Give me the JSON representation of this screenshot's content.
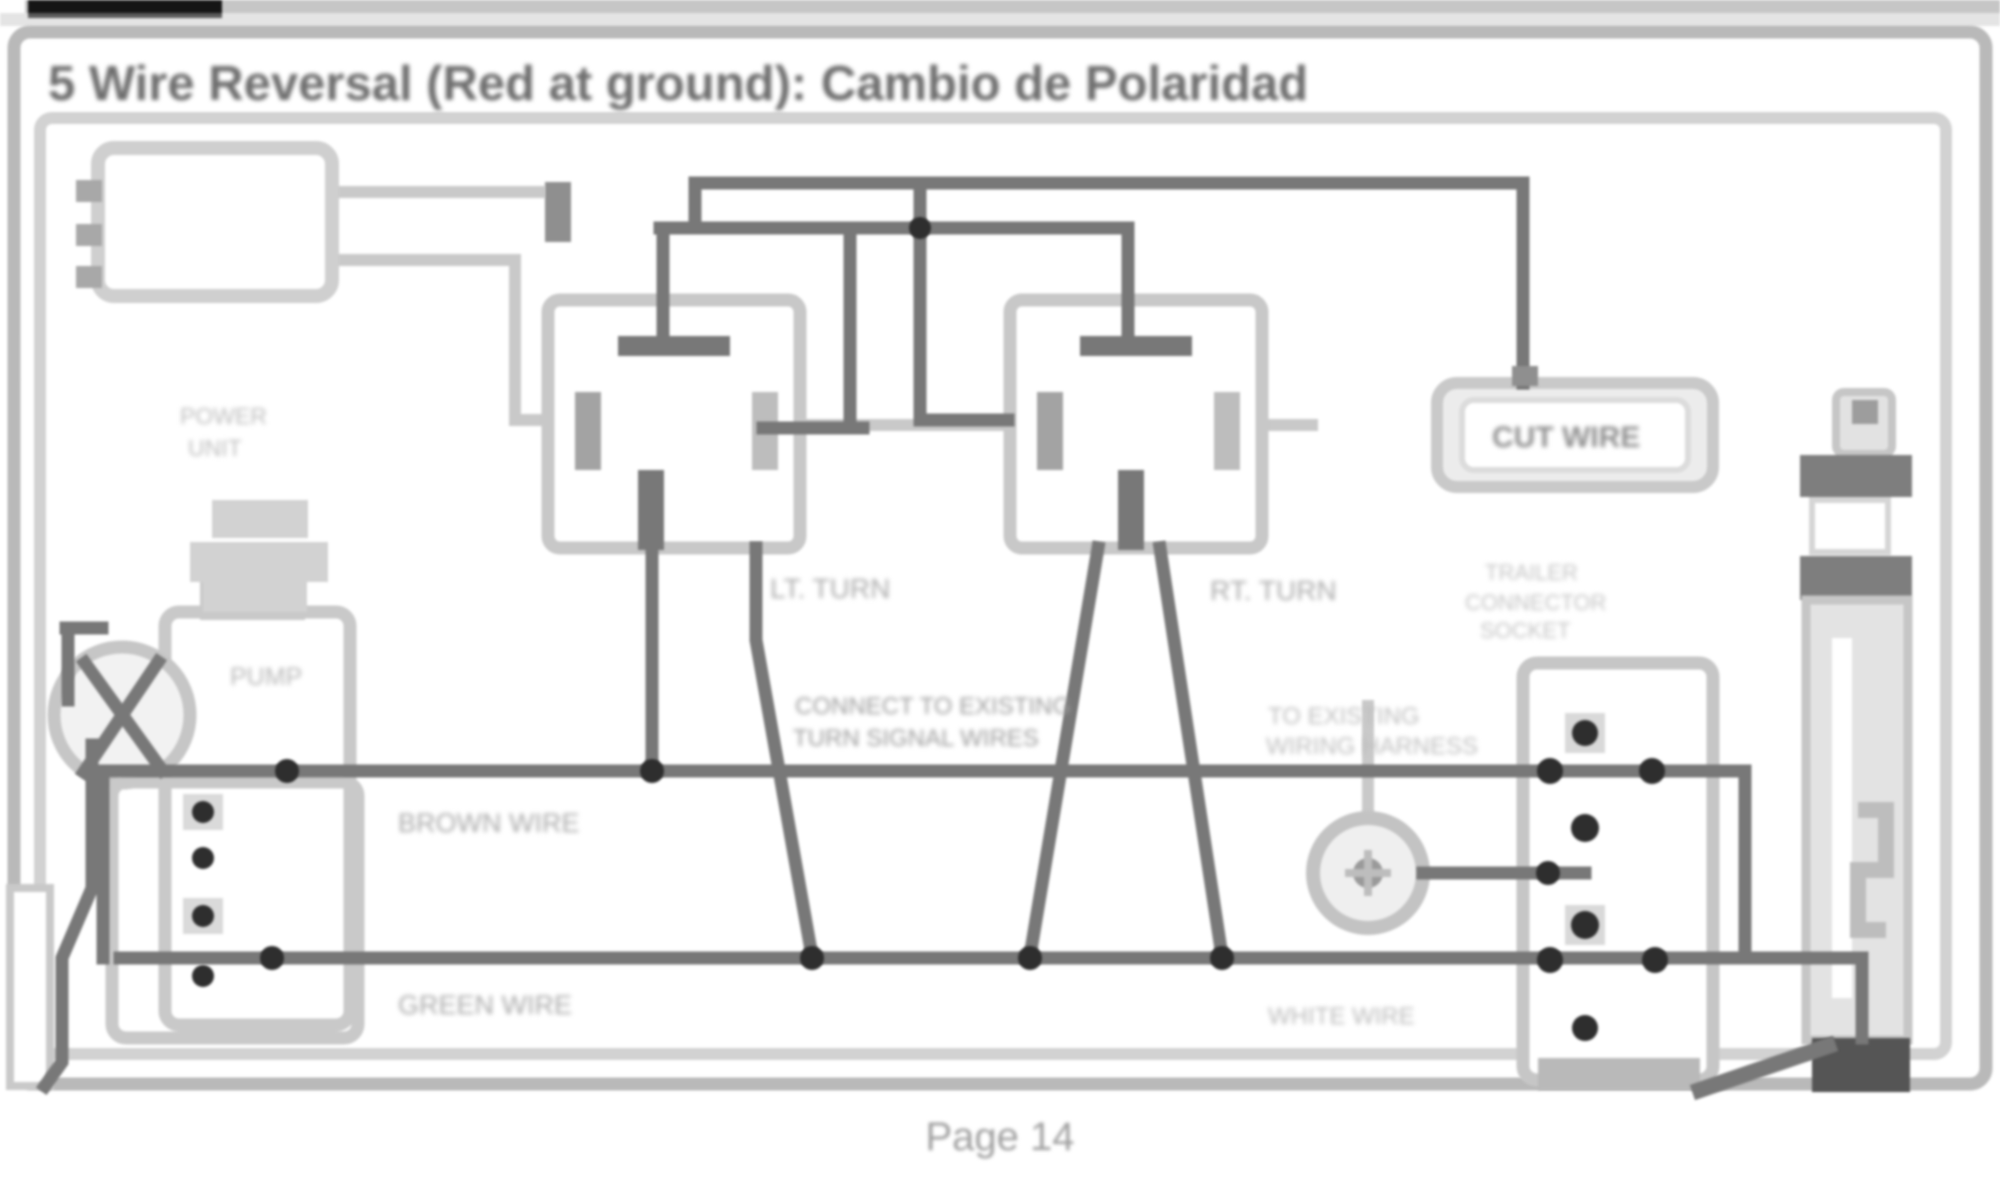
{
  "page": {
    "title": "5 Wire Reversal (Red at ground): Cambio de Polaridad",
    "page_label": "Page 14"
  },
  "labels": {
    "cut_wire": "CUT WIRE",
    "lt_turn": "LT. TURN",
    "rt_turn": "RT. TURN",
    "center_note_1": "CONNECT TO EXISTING",
    "center_note_2": "TURN SIGNAL WIRES",
    "right_note_1": "TO EXISTING",
    "right_note_2": "WIRING HARNESS",
    "trailer_1": "TRAILER",
    "trailer_2": "CONNECTOR",
    "trailer_3": "SOCKET",
    "wire_upper": "BROWN WIRE",
    "wire_lower": "GREEN WIRE",
    "wire_right": "WHITE WIRE",
    "pump": "PUMP",
    "pump_note_1": "POWER",
    "pump_note_2": "UNIT"
  },
  "components": {
    "vehicle_connector": "wiring connector with pins",
    "left_switch": "left turn lamp switch",
    "right_switch": "right turn lamp switch",
    "cut_wire_box": "cut-wire callout box",
    "circuit_breaker": "in-line breaker cylinder",
    "pump_reservoir": "pump reservoir bottle",
    "motor": "motor circle",
    "left_terminal_block": "left junction block",
    "right_terminal_block": "right junction block",
    "breakaway_switch": "round switch"
  },
  "colors": {
    "wire_dark": "#787878",
    "outline_light": "#c8c8c8",
    "junction_black": "#2e2e2e",
    "title_gray": "#6e6e6e",
    "band_gray": "#c9c9c9",
    "top_bar_black": "#151515"
  }
}
